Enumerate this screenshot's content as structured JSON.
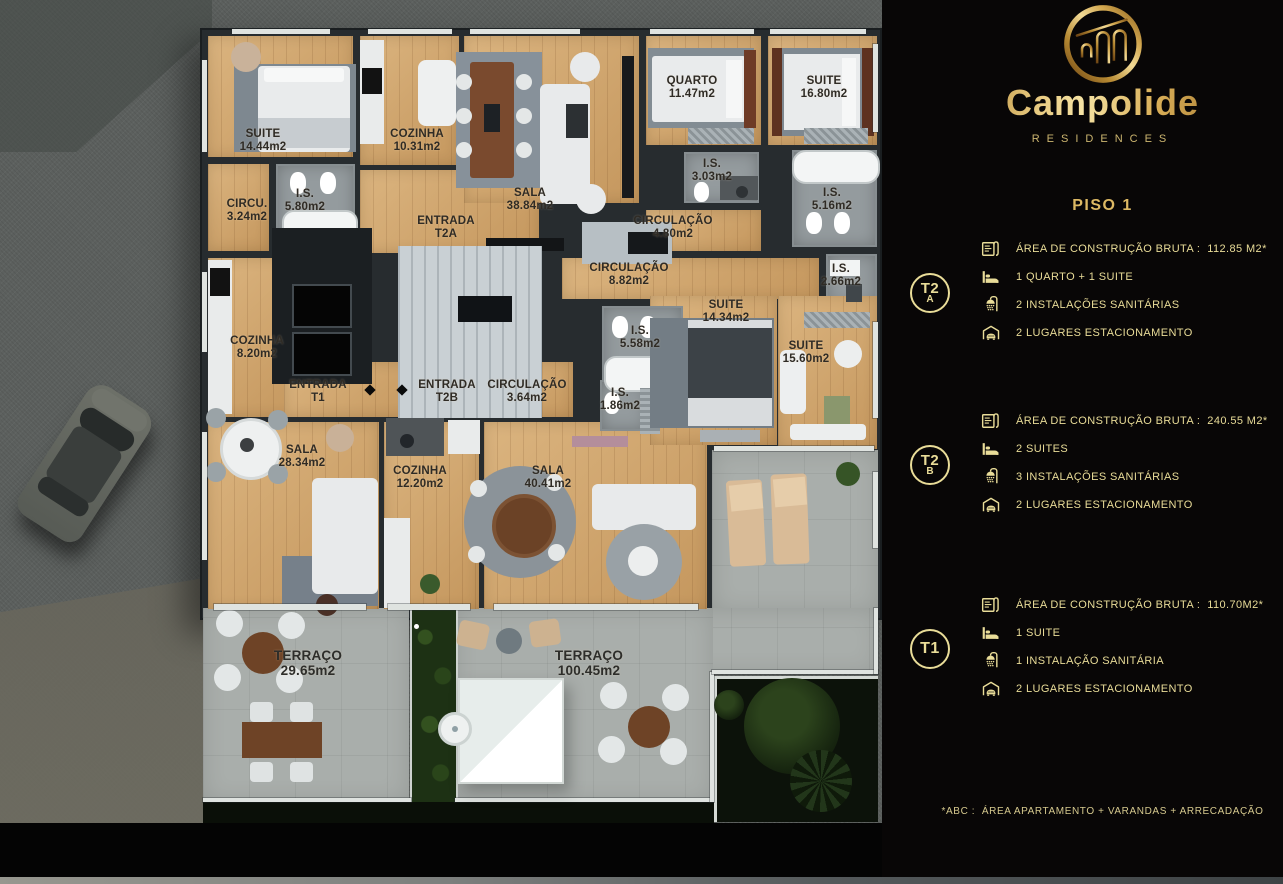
{
  "brand": {
    "name": "Campolide",
    "subtitle": "RESIDENCES"
  },
  "page_title": "PISO 1",
  "footnote": "*ABC :  ÁREA APARTAMENTO + VARANDAS + ARRECADAÇÃO",
  "colors": {
    "gold_text": "#e9dc98",
    "gold_title": "#ddb964",
    "wood": "#cfa267",
    "tile": "#949b9e",
    "stone": "#a9aeab",
    "asphalt": "#5c605e",
    "panel_bg": "#080606"
  },
  "units": [
    {
      "id": "T2A",
      "badge": "T2",
      "badge_sub": "A",
      "top": 249,
      "badge_cy": 293,
      "specs": [
        {
          "icon": "blueprint",
          "text": "ÁREA DE CONSTRUÇÃO BRUTA :  112.85 M2*"
        },
        {
          "icon": "bed",
          "text": "1 QUARTO + 1 SUITE"
        },
        {
          "icon": "shower",
          "text": "2 INSTALAÇÕES SANITÁRIAS"
        },
        {
          "icon": "garage",
          "text": "2 LUGARES ESTACIONAMENTO"
        }
      ]
    },
    {
      "id": "T2B",
      "badge": "T2",
      "badge_sub": "B",
      "top": 421,
      "badge_cy": 465,
      "specs": [
        {
          "icon": "blueprint",
          "text": "ÁREA DE CONSTRUÇÃO BRUTA :  240.55 M2*"
        },
        {
          "icon": "bed",
          "text": "2 SUITES"
        },
        {
          "icon": "shower",
          "text": "3 INSTALAÇÕES SANITÁRIAS"
        },
        {
          "icon": "garage",
          "text": "2 LUGARES ESTACIONAMENTO"
        }
      ]
    },
    {
      "id": "T1",
      "badge": "T1",
      "badge_sub": "",
      "top": 605,
      "badge_cy": 649,
      "specs": [
        {
          "icon": "blueprint",
          "text": "ÁREA DE CONSTRUÇÃO BRUTA :  110.70M2*"
        },
        {
          "icon": "bed",
          "text": "1 SUITE"
        },
        {
          "icon": "shower",
          "text": "1 INSTALAÇÃO SANITÁRIA"
        },
        {
          "icon": "garage",
          "text": "2 LUGARES ESTACIONAMENTO"
        }
      ]
    }
  ],
  "plan": {
    "rooms": [
      {
        "name": "SUITE",
        "area": "14.44m2",
        "x": 206,
        "y": 34,
        "w": 148,
        "h": 124,
        "floor": "wood",
        "lx": 263,
        "ly": 141
      },
      {
        "name": "CIRCU.",
        "area": "3.24m2",
        "x": 206,
        "y": 162,
        "w": 64,
        "h": 90,
        "floor": "wood",
        "lx": 247,
        "ly": 211
      },
      {
        "name": "I.S.",
        "area": "5.80m2",
        "x": 274,
        "y": 162,
        "w": 82,
        "h": 90,
        "floor": "tile",
        "lx": 305,
        "ly": 201
      },
      {
        "name": "COZINHA",
        "area": "10.31m2",
        "x": 358,
        "y": 34,
        "w": 102,
        "h": 132,
        "floor": "wood",
        "lx": 417,
        "ly": 141
      },
      {
        "name": "ENTRADA",
        "area": "T2A",
        "x": 358,
        "y": 168,
        "w": 182,
        "h": 86,
        "floor": "wood",
        "lx": 446,
        "ly": 228
      },
      {
        "name": "SALA",
        "area": "38.84m2",
        "x": 462,
        "y": 34,
        "w": 178,
        "h": 170,
        "floor": "wood",
        "lx": 530,
        "ly": 200
      },
      {
        "name": "QUARTO",
        "area": "11.47m2",
        "x": 644,
        "y": 34,
        "w": 118,
        "h": 112,
        "floor": "wood",
        "lx": 692,
        "ly": 88
      },
      {
        "name": "SUITE",
        "area": "16.80m2",
        "x": 766,
        "y": 34,
        "w": 112,
        "h": 112,
        "floor": "wood",
        "lx": 824,
        "ly": 88
      },
      {
        "name": "I.S.",
        "area": "3.03m2",
        "x": 682,
        "y": 150,
        "w": 78,
        "h": 54,
        "floor": "tile",
        "lx": 712,
        "ly": 171
      },
      {
        "name": "I.S.",
        "area": "5.16m2",
        "x": 790,
        "y": 148,
        "w": 88,
        "h": 100,
        "floor": "tile",
        "lx": 832,
        "ly": 200
      },
      {
        "name": "CIRCULAÇÃO",
        "area": "4.80m2",
        "x": 644,
        "y": 208,
        "w": 118,
        "h": 44,
        "floor": "wood",
        "lx": 673,
        "ly": 228
      },
      {
        "name": "CIRCULAÇÃO",
        "area": "8.82m2",
        "x": 560,
        "y": 256,
        "w": 260,
        "h": 44,
        "floor": "wood",
        "lx": 629,
        "ly": 275
      },
      {
        "name": "I.S.",
        "area": "2.66m2",
        "x": 824,
        "y": 252,
        "w": 54,
        "h": 54,
        "floor": "tile",
        "lx": 841,
        "ly": 276
      },
      {
        "name": "COZINHA",
        "area": "8.20m2",
        "x": 206,
        "y": 256,
        "w": 98,
        "h": 162,
        "floor": "wood",
        "lx": 257,
        "ly": 348
      },
      {
        "name": "ENTRADA",
        "area": "T1",
        "x": 282,
        "y": 360,
        "w": 144,
        "h": 58,
        "floor": "wood",
        "lx": 318,
        "ly": 392
      },
      {
        "name": "ENTRADA",
        "area": "T2B",
        "x": 428,
        "y": 360,
        "w": 58,
        "h": 58,
        "floor": "wood",
        "lx": 447,
        "ly": 392
      },
      {
        "name": "CIRCULAÇÃO",
        "area": "3.64m2",
        "x": 488,
        "y": 360,
        "w": 86,
        "h": 58,
        "floor": "wood",
        "lx": 527,
        "ly": 392
      },
      {
        "name": "SALA",
        "area": "28.34m2",
        "x": 206,
        "y": 420,
        "w": 174,
        "h": 190,
        "floor": "wood",
        "lx": 302,
        "ly": 457
      },
      {
        "name": "COZINHA",
        "area": "12.20m2",
        "x": 382,
        "y": 420,
        "w": 98,
        "h": 190,
        "floor": "wood",
        "lx": 420,
        "ly": 478
      },
      {
        "name": "SALA",
        "area": "40.41m2",
        "x": 482,
        "y": 420,
        "w": 226,
        "h": 190,
        "floor": "wood",
        "lx": 548,
        "ly": 478
      },
      {
        "name": "SUITE",
        "area": "14.34m2",
        "x": 648,
        "y": 294,
        "w": 130,
        "h": 152,
        "floor": "wood",
        "lx": 726,
        "ly": 312
      },
      {
        "name": "I.S.",
        "area": "5.58m2",
        "x": 600,
        "y": 304,
        "w": 84,
        "h": 90,
        "floor": "tile",
        "lx": 640,
        "ly": 338
      },
      {
        "name": "SUITE",
        "area": "15.60m2",
        "x": 776,
        "y": 294,
        "w": 102,
        "h": 156,
        "floor": "wood",
        "lx": 806,
        "ly": 353
      },
      {
        "name": "I.S.",
        "area": "1.86m2",
        "x": 598,
        "y": 378,
        "w": 50,
        "h": 54,
        "floor": "tile",
        "lx": 620,
        "ly": 400
      },
      {
        "name": "TERRAÇO",
        "area": "29.65m2",
        "x": 0,
        "y": 0,
        "w": 0,
        "h": 0,
        "floor": "none",
        "lx": 308,
        "ly": 663
      },
      {
        "name": "TERRAÇO",
        "area": "100.45m2",
        "x": 0,
        "y": 0,
        "w": 0,
        "h": 0,
        "floor": "none",
        "lx": 589,
        "ly": 663
      }
    ]
  }
}
